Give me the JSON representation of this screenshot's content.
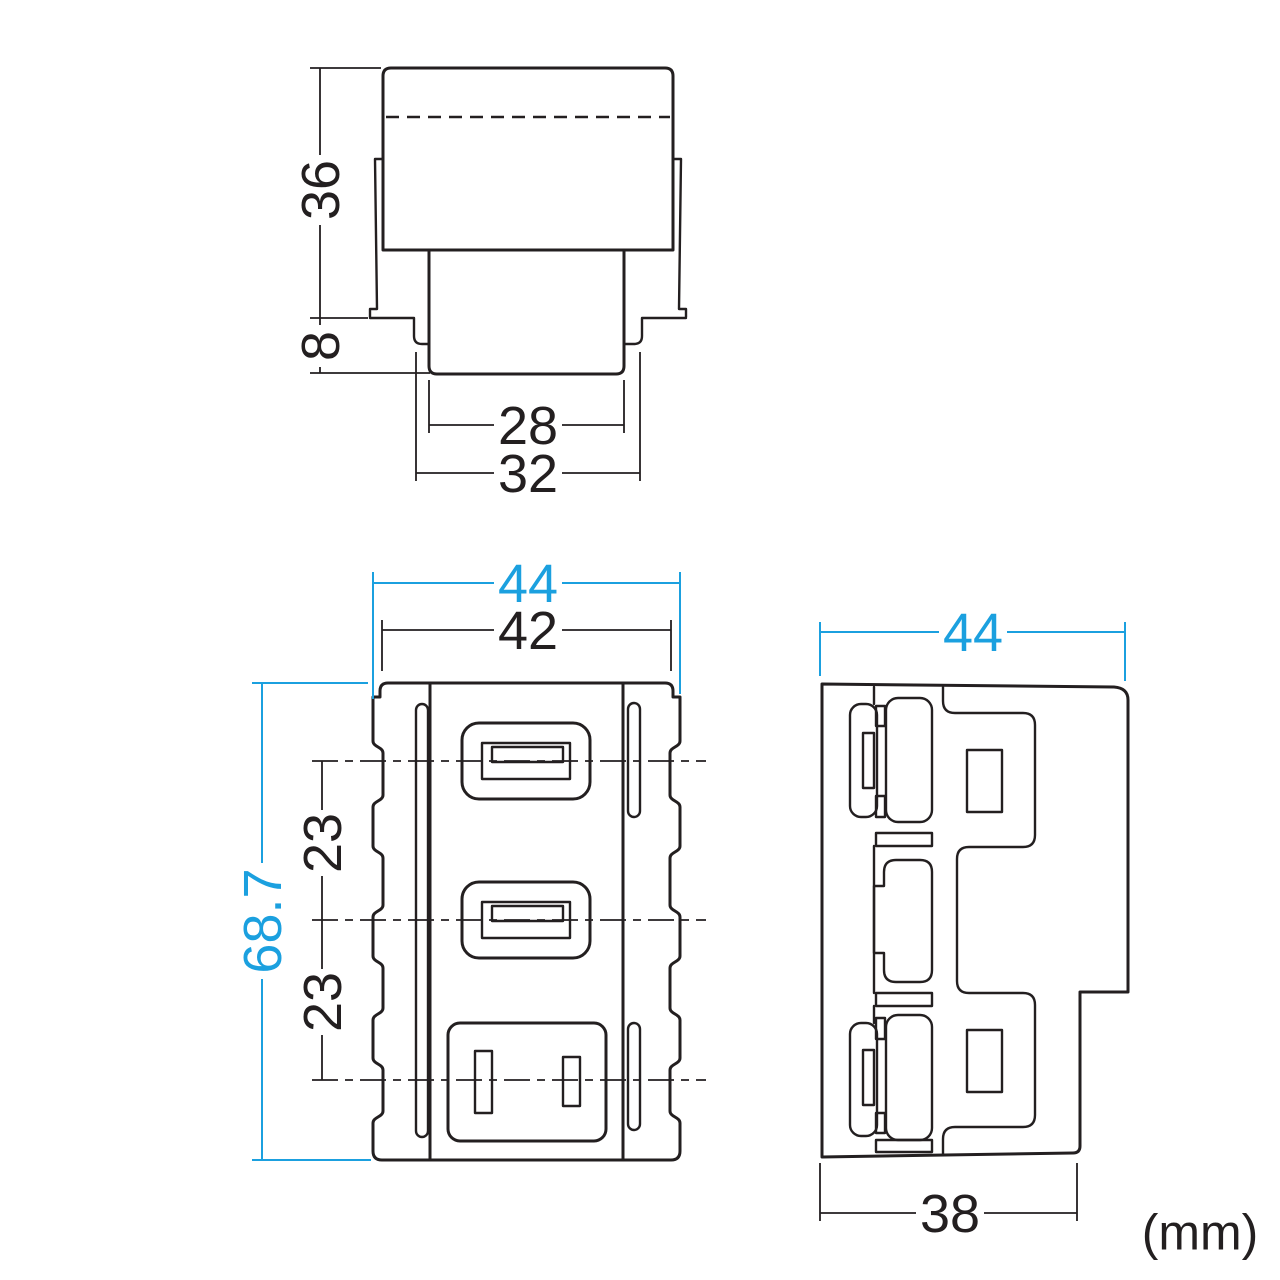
{
  "unit_label": "(mm)",
  "colors": {
    "line": "#231F20",
    "accent": "#1BA0DF"
  },
  "top_view": {
    "description": "top elevation of outlet module",
    "dims": {
      "height": "36",
      "flange_depth": "8",
      "inner_width": "28",
      "outer_width": "32"
    }
  },
  "front_view": {
    "description": "front face with two USB-A ports and one AC outlet",
    "dims": {
      "outer_width": "44",
      "body_width": "42",
      "height": "68.7",
      "port_pitch_upper": "23",
      "port_pitch_lower": "23"
    }
  },
  "side_view": {
    "description": "side profile with mounting clips",
    "dims": {
      "depth": "44",
      "bottom_depth": "38"
    }
  }
}
